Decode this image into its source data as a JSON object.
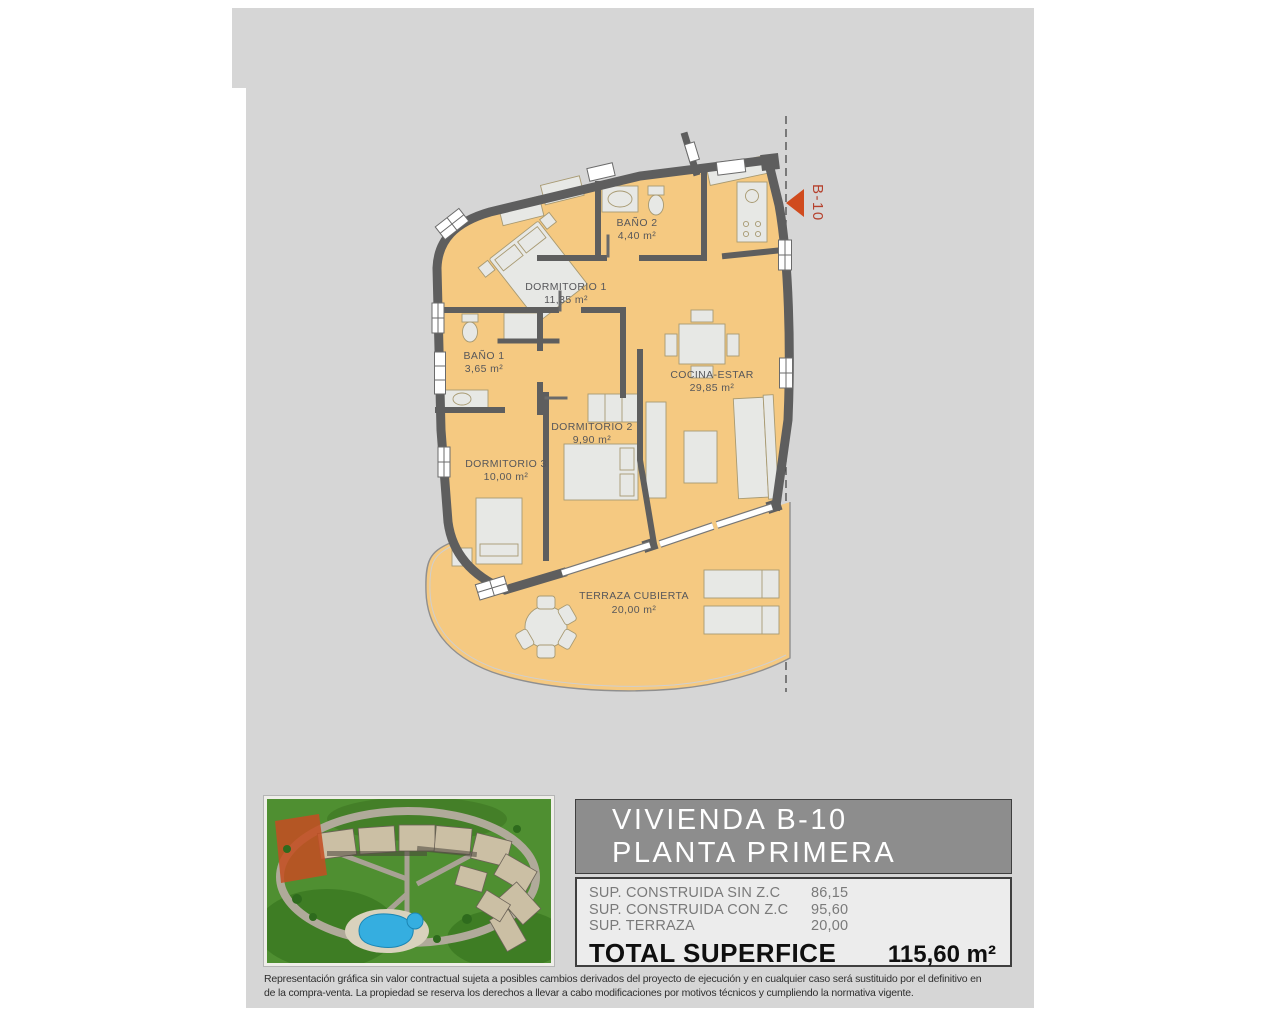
{
  "plan": {
    "marker_label": "B-10",
    "rooms": [
      {
        "name": "BAÑO 2",
        "area": "4,40 m²"
      },
      {
        "name": "DORMITORIO 1",
        "area": "11,35 m²"
      },
      {
        "name": "BAÑO 1",
        "area": "3,65 m²"
      },
      {
        "name": "COCINA-ESTAR",
        "area": "29,85 m²"
      },
      {
        "name": "DORMITORIO 2",
        "area": "9,90 m²"
      },
      {
        "name": "DORMITORIO 3",
        "area": "10,00 m²"
      },
      {
        "name": "TERRAZA CUBIERTA",
        "area": "20,00 m²"
      }
    ],
    "colors": {
      "floor": "#f5c981",
      "wall": "#5e5e5e",
      "marker_red": "#b5402c",
      "arrow_orange": "#d04b1e"
    }
  },
  "info_panel": {
    "title_line1": "VIVIENDA B-10",
    "title_line2": "PLANTA PRIMERA",
    "rows": [
      {
        "label": "SUP. CONSTRUIDA SIN Z.C",
        "value": "86,15"
      },
      {
        "label": "SUP. CONSTRUIDA CON Z.C",
        "value": "95,60"
      },
      {
        "label": "SUP. TERRAZA",
        "value": "20,00"
      }
    ],
    "total_label": "TOTAL SUPERFICE",
    "total_value": "115,60 m²"
  },
  "thumbnail": {
    "description": "aerial-site-view-with-highlighted-block"
  },
  "disclaimer": {
    "line1": "Representación gráfica sin valor contractual sujeta a posibles cambios derivados del proyecto de ejecución y en cualquier caso será sustituido por el definitivo en",
    "line2": "de la compra-venta. La propiedad se reserva los derechos a llevar a cabo modificaciones por motivos técnicos y cumpliendo la normativa vigente."
  }
}
